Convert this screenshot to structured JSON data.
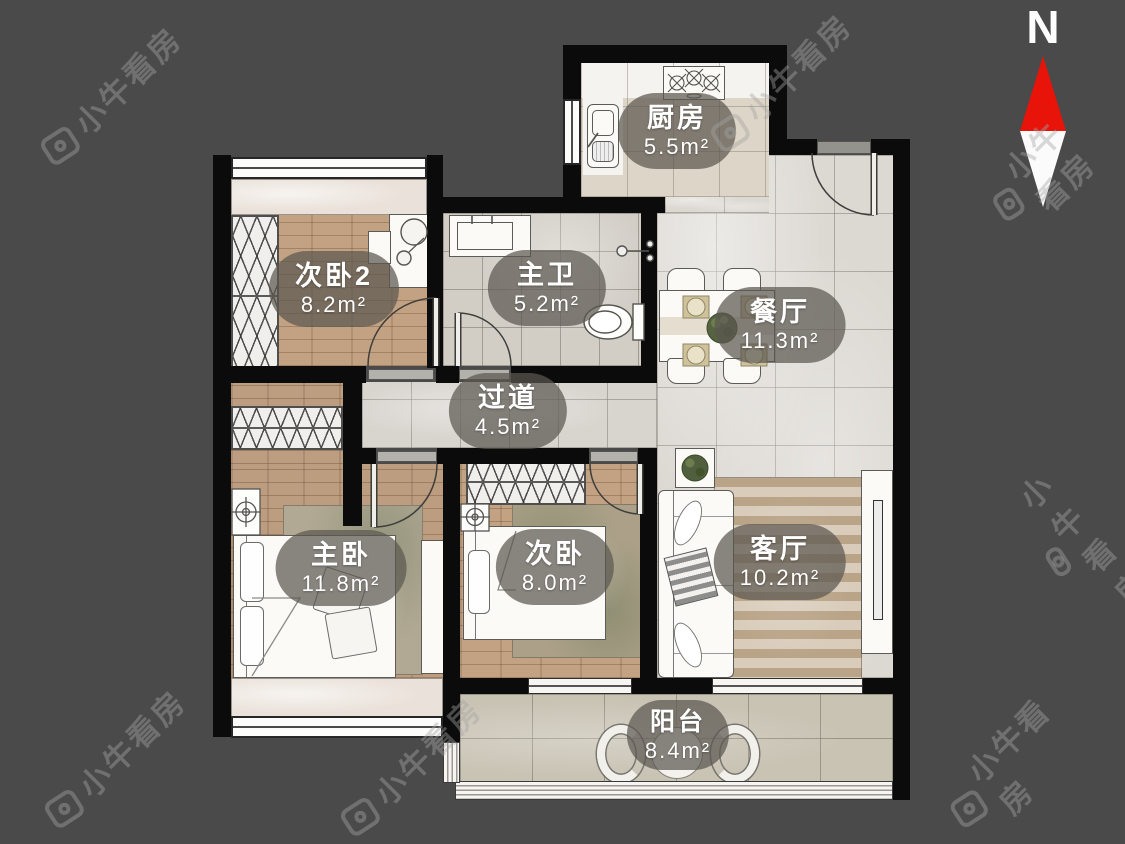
{
  "brand": {
    "watermark_text": "小牛看房"
  },
  "compass": {
    "label": "N"
  },
  "rooms": [
    {
      "id": "kitchen",
      "name": "厨房",
      "area": "5.5m²"
    },
    {
      "id": "bedroom2",
      "name": "次卧2",
      "area": "8.2m²"
    },
    {
      "id": "master-bath",
      "name": "主卫",
      "area": "5.2m²"
    },
    {
      "id": "dining-room",
      "name": "餐厅",
      "area": "11.3m²"
    },
    {
      "id": "hallway",
      "name": "过道",
      "area": "4.5m²"
    },
    {
      "id": "master-bedroom",
      "name": "主卧",
      "area": "11.8m²"
    },
    {
      "id": "bedroom",
      "name": "次卧",
      "area": "8.0m²"
    },
    {
      "id": "living-room",
      "name": "客厅",
      "area": "10.2m²"
    },
    {
      "id": "balcony",
      "name": "阳台",
      "area": "8.4m²"
    }
  ],
  "colors": {
    "background": "#4a4a4a",
    "wall": "#0b0b0b",
    "compass_north": "#e81309",
    "label_pill": "rgba(92,87,81,0.72)"
  }
}
